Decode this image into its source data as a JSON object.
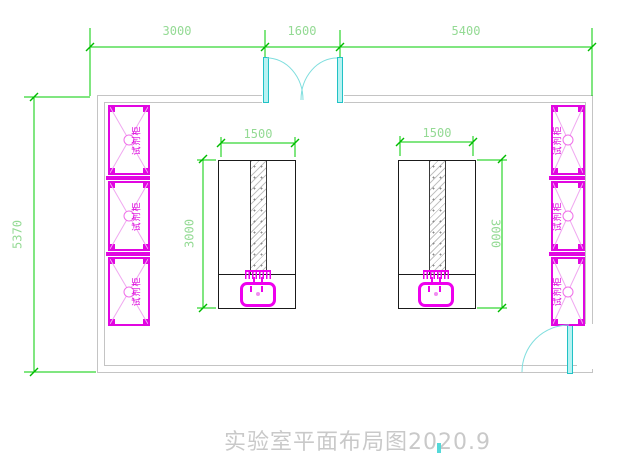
{
  "drawing": {
    "title": "实验室平面布局图2020.9"
  },
  "dimensions": {
    "top": [
      {
        "label": "3000"
      },
      {
        "label": "1600"
      },
      {
        "label": "5400"
      }
    ],
    "left": {
      "label": "5370"
    },
    "bench": {
      "width": "1500",
      "depth": "3000"
    }
  },
  "cabinet": {
    "label": "试剂柜"
  },
  "colors": {
    "dimension_line": "#00cc00",
    "dimension_text": "#94da94",
    "cabinet": "#e106e1",
    "sink": "#ee00ee",
    "door": "#21c2c6",
    "wall": "#c4c4c4",
    "bench_outline": "#1a1a1a",
    "title_text": "#c9c9c9"
  }
}
